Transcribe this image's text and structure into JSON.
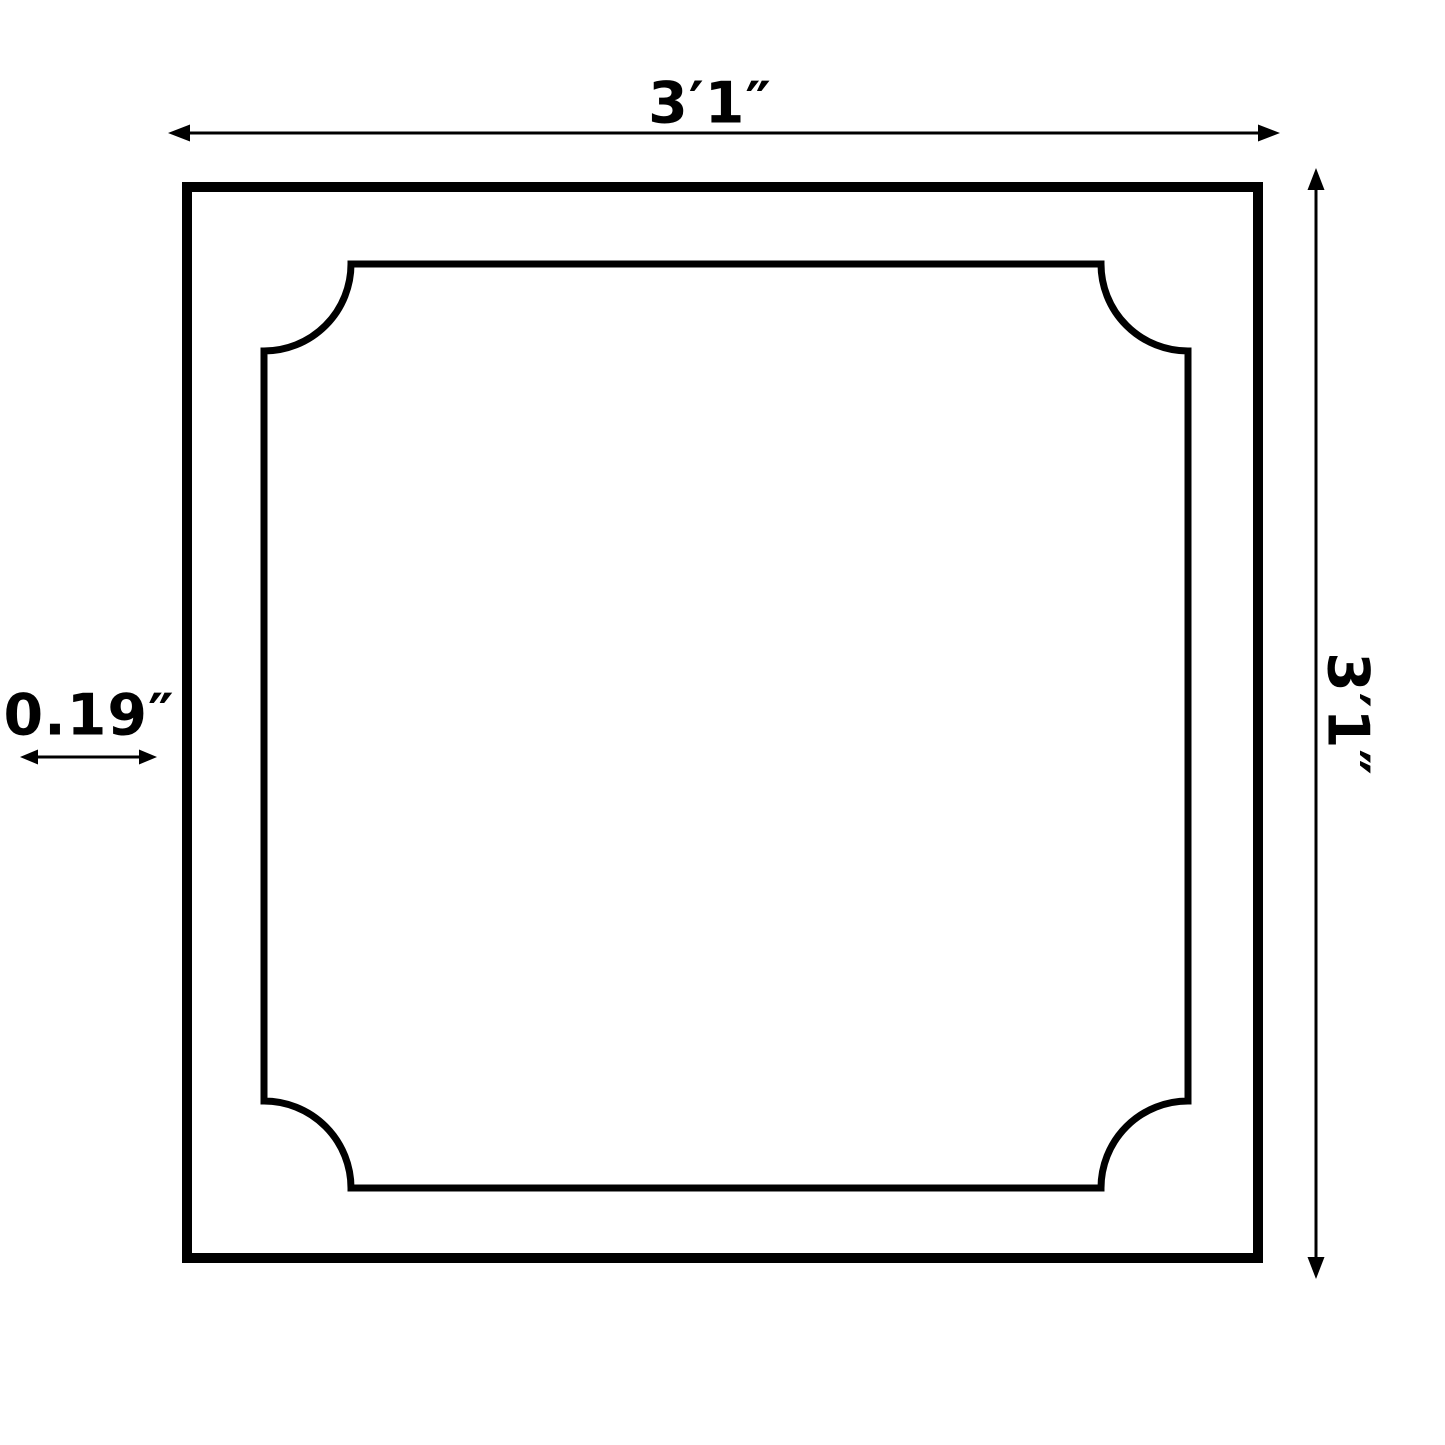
{
  "diagram": {
    "type": "product-dimension-drawing",
    "subject": "square ceiling tile / panel with scalloped inner border",
    "dimensions": {
      "width_label": "3′1″",
      "height_label": "3′1″",
      "thickness_label": "0.19″"
    },
    "colors": {
      "line": "#000000",
      "background": "#ffffff"
    }
  }
}
